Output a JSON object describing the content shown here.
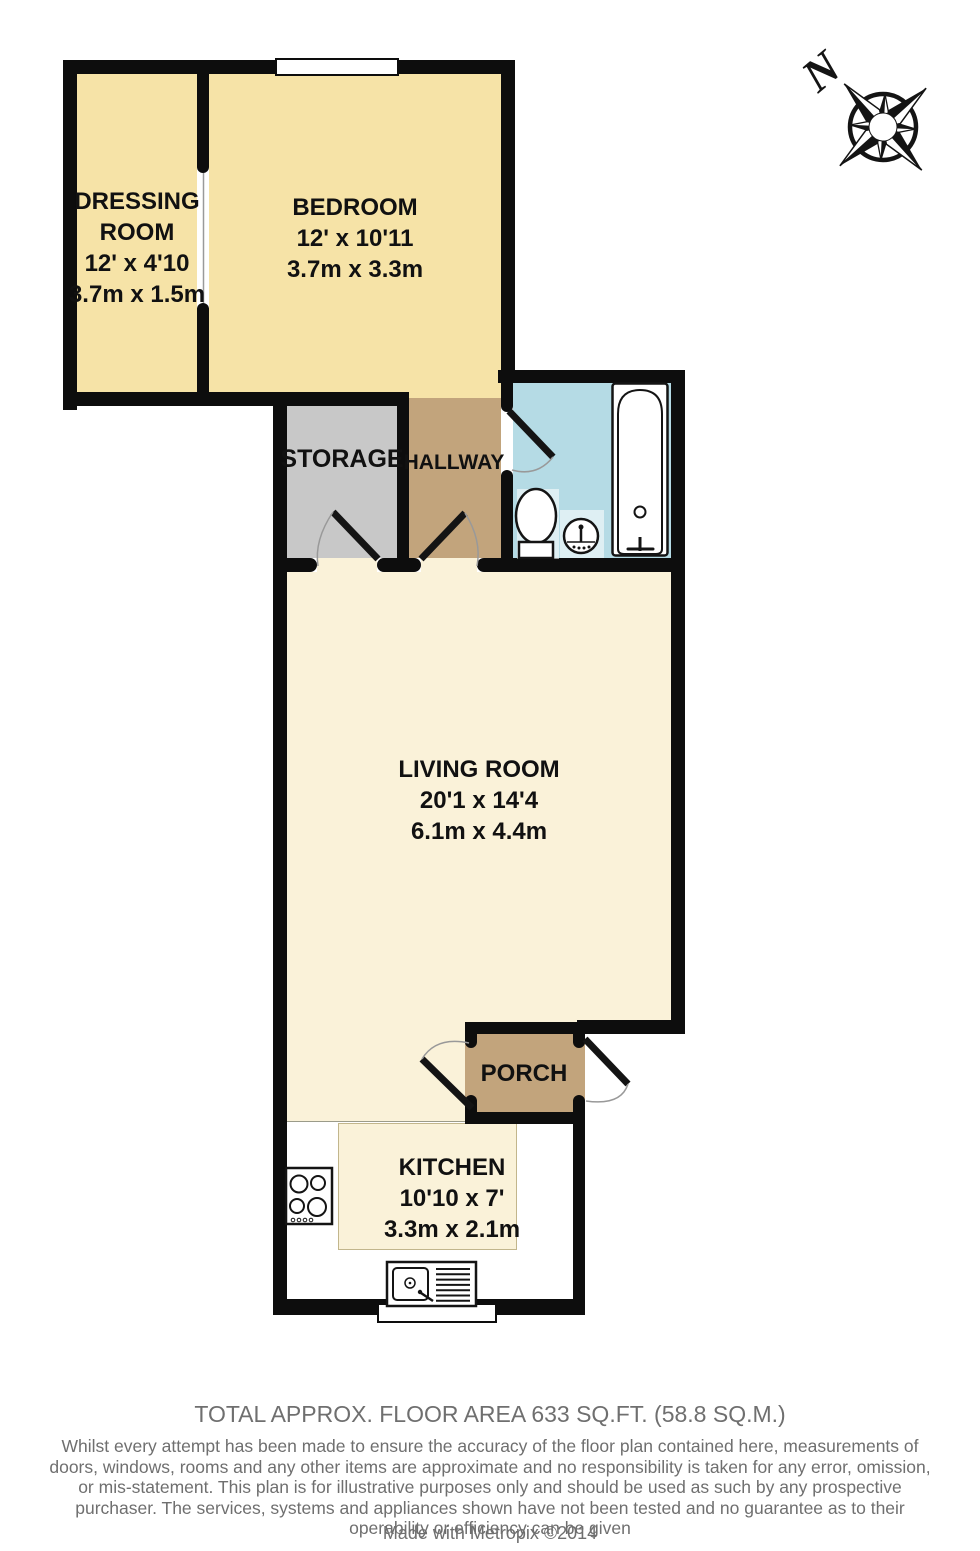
{
  "plan": {
    "rooms": {
      "dressing": {
        "name_line1": "DRESSING",
        "name_line2": "ROOM",
        "dim_imperial": "12' x 4'10",
        "dim_metric": "3.7m x 1.5m"
      },
      "bedroom": {
        "name": "BEDROOM",
        "dim_imperial": "12' x 10'11",
        "dim_metric": "3.7m x 3.3m"
      },
      "storage": {
        "name": "STORAGE"
      },
      "hallway": {
        "name": "HALLWAY"
      },
      "living_room": {
        "name": "LIVING ROOM",
        "dim_imperial": "20'1 x 14'4",
        "dim_metric": "6.1m x 4.4m"
      },
      "porch": {
        "name": "PORCH"
      },
      "kitchen": {
        "name": "KITCHEN",
        "dim_imperial": "10'10 x 7'",
        "dim_metric": "3.3m x 2.1m"
      }
    },
    "compass": {
      "north_label": "N"
    },
    "fixture_icons": [
      "bathtub-icon",
      "toilet-icon",
      "basin-icon",
      "hob-icon",
      "kitchen-sink-icon",
      "compass-rose-icon"
    ]
  },
  "footer": {
    "total_area": "TOTAL APPROX. FLOOR AREA 633 SQ.FT. (58.8 SQ.M.)",
    "disclaimer": "Whilst every attempt has been made to ensure the accuracy of the floor plan contained here, measurements of doors, windows, rooms and any other items are approximate and no responsibility is taken for any error, omission, or mis-statement. This plan is for illustrative purposes only and should be used as such by any prospective purchaser. The services, systems and appliances shown have not been tested and no guarantee as to their operability or efficiency can be given",
    "credit": "Made with Metropix ©2014"
  },
  "colors": {
    "wall": "#0d0d0d",
    "room-yellow": "#f6e3a7",
    "room-cream": "#faf2d9",
    "room-gray": "#c8c8c8",
    "room-tan": "#c2a47c",
    "room-blue": "#b5dbe5",
    "label-text": "#111111",
    "footer-text": "#6f6f6f"
  }
}
